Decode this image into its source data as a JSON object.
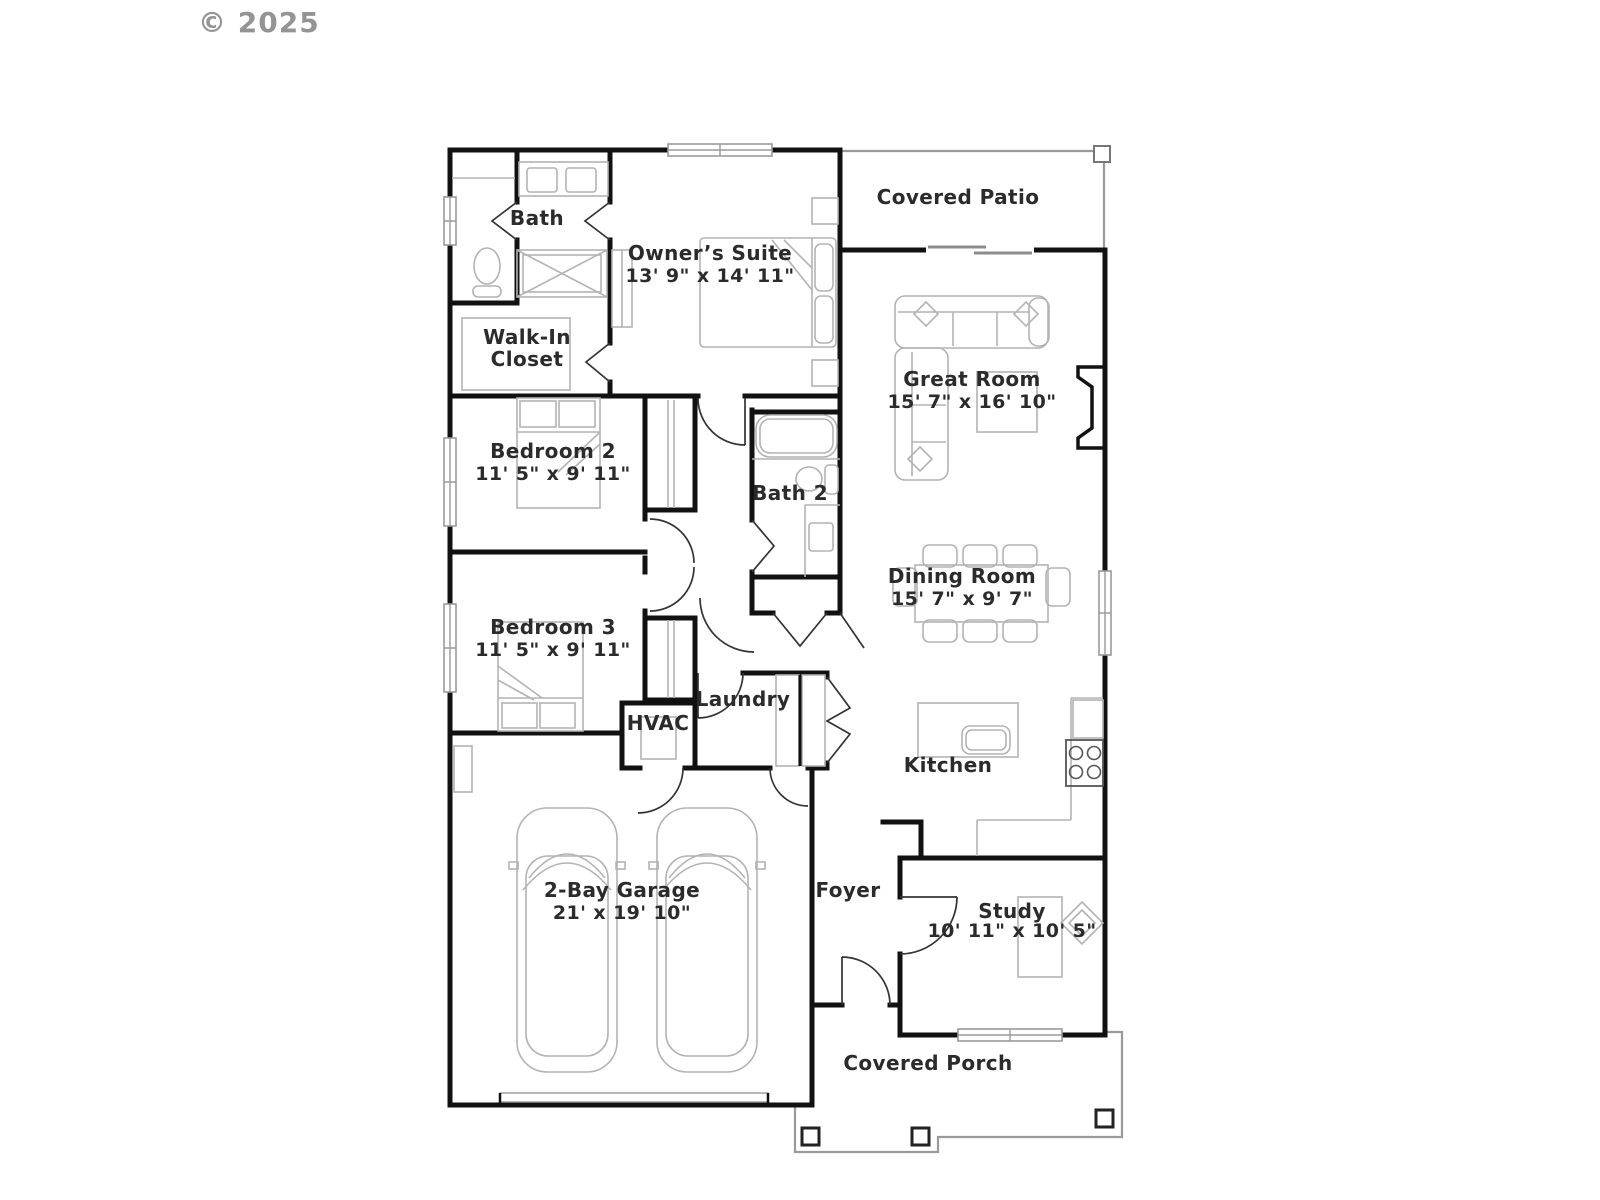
{
  "copyright": "© 2025",
  "rooms": {
    "bath": {
      "label": "Bath"
    },
    "walk_in_closet": {
      "lines": [
        "Walk-In",
        "Closet"
      ]
    },
    "owners_suite": {
      "label": "Owner’s Suite",
      "dims": "13' 9\" x 14' 11\""
    },
    "covered_patio": {
      "label": "Covered Patio"
    },
    "great_room": {
      "label": "Great Room",
      "dims": "15' 7\" x 16' 10\""
    },
    "bedroom2": {
      "label": "Bedroom 2",
      "dims": "11' 5\" x 9' 11\""
    },
    "bath2": {
      "label": "Bath 2"
    },
    "dining_room": {
      "label": "Dining Room",
      "dims": "15' 7\" x 9' 7\""
    },
    "bedroom3": {
      "label": "Bedroom 3",
      "dims": "11' 5\" x 9' 11\""
    },
    "laundry": {
      "label": "Laundry"
    },
    "hvac": {
      "label": "HVAC"
    },
    "kitchen": {
      "label": "Kitchen"
    },
    "garage": {
      "label": "2-Bay Garage",
      "dims": "21' x 19' 10\""
    },
    "foyer": {
      "label": "Foyer"
    },
    "study": {
      "label": "Study",
      "dims": "10' 11\" x 10' 5\""
    },
    "covered_porch": {
      "label": "Covered Porch"
    }
  },
  "colors": {
    "wall": "#111111",
    "fixture": "#b3b3b3",
    "text": "#2b2b2b",
    "copyright": "#949494"
  }
}
